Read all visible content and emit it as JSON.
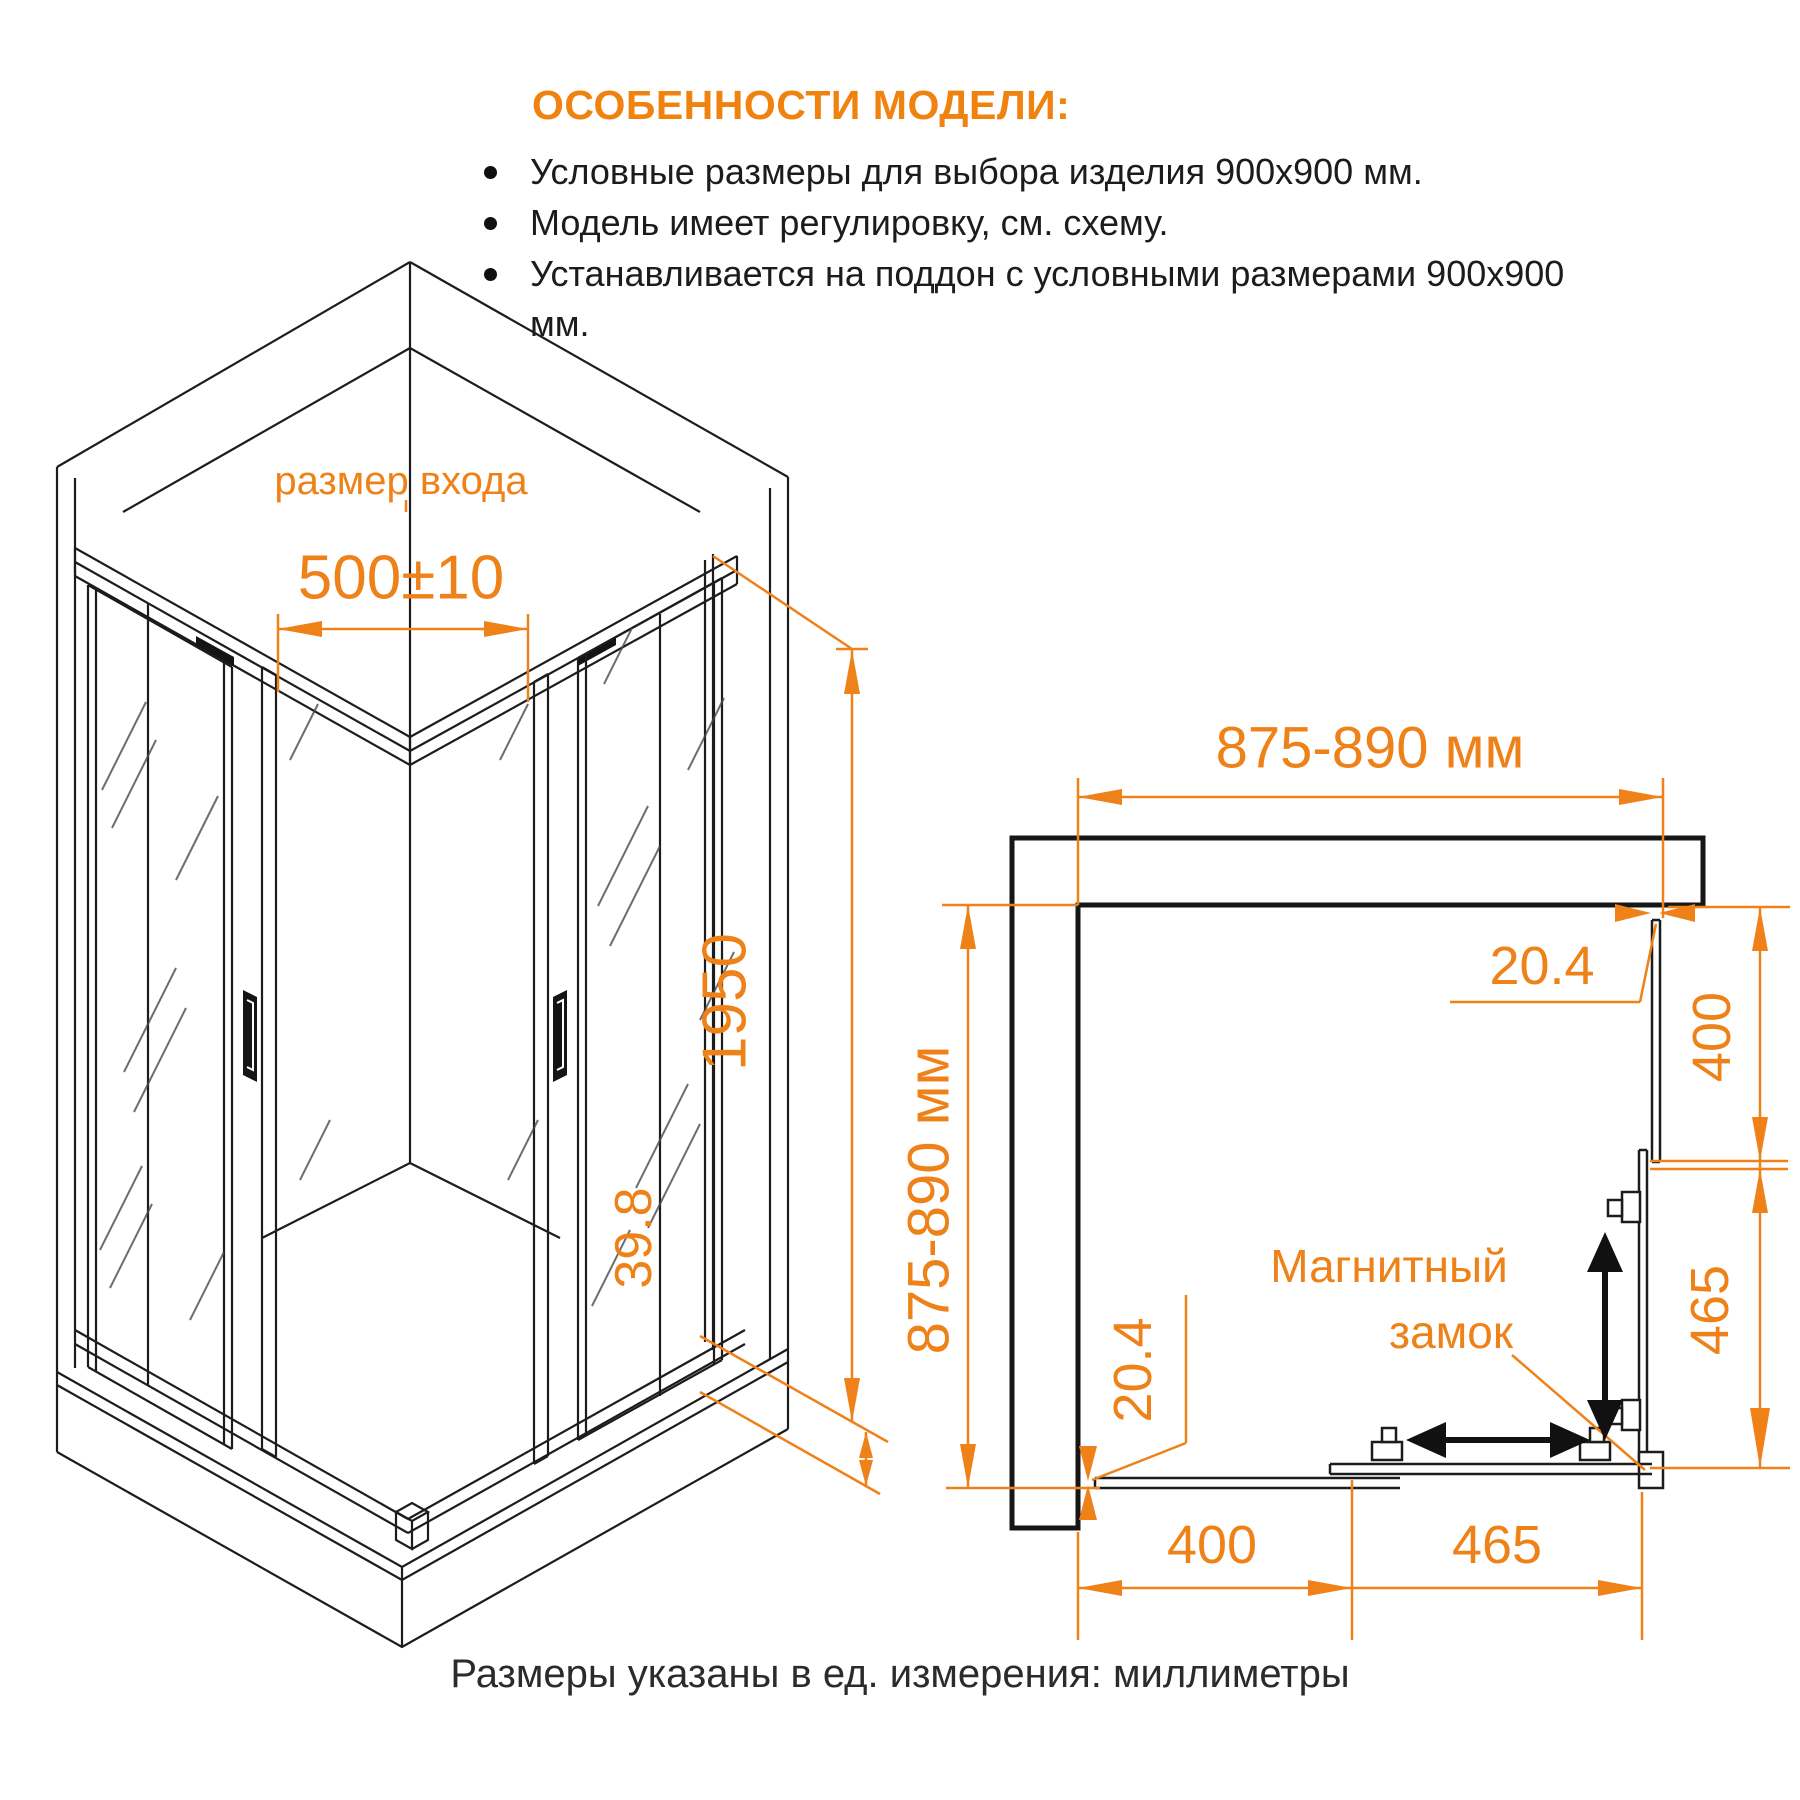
{
  "colors": {
    "accent": "#ef8119",
    "ink": "#1f1f1f"
  },
  "features": {
    "title": "ОСОБЕННОСТИ МОДЕЛИ:",
    "items": [
      "Условные размеры для выбора изделия 900х900 мм.",
      "Модель имеет регулировку, см. схему.",
      "Устанавливается на поддон с условными размерами 900х900 мм."
    ]
  },
  "iso": {
    "entrance_label": "размер входа",
    "entrance_size": "500±10",
    "height": "1950",
    "tray_height": "39.8"
  },
  "plan": {
    "width_top": "875-890 мм",
    "depth_left": "875-890 мм",
    "adjust_top": "20.4",
    "adjust_bottom": "20.4",
    "right_fixed": "400",
    "right_door": "465",
    "bottom_fixed": "400",
    "bottom_door": "465",
    "lock_line1": "Магнитный",
    "lock_line2": "замок"
  },
  "footer": {
    "units_note": "Размеры указаны в ед. измерения: миллиметры"
  }
}
